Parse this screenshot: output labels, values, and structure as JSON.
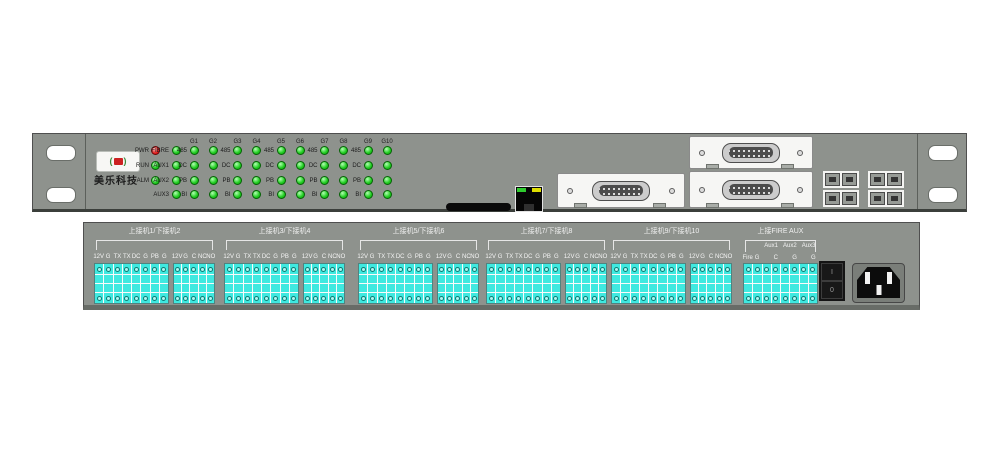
{
  "front_panel": {
    "brand_name": "美乐科技",
    "led_column_headers": [
      "G1",
      "G2",
      "G3",
      "G4",
      "G5",
      "G6",
      "G7",
      "G8",
      "G9",
      "G10"
    ],
    "led_rows": [
      {
        "status": "PWR",
        "status_color": "red",
        "aux": "FIBRE",
        "pair_label": "485"
      },
      {
        "status": "RUN",
        "status_color": "green",
        "aux": "AUX1",
        "pair_label": "DC"
      },
      {
        "status": "ALM",
        "status_color": "green",
        "aux": "AUX2",
        "pair_label": "PB"
      },
      {
        "status": "",
        "status_color": "",
        "aux": "AUX3",
        "pair_label": "BI"
      }
    ]
  },
  "rear_panel": {
    "channel_groups": [
      {
        "label": "上接机1/下接机2"
      },
      {
        "label": "上接机3/下接机4"
      },
      {
        "label": "上接机5/下接机6"
      },
      {
        "label": "上接机7/下接机8"
      },
      {
        "label": "上接机9/下接机10"
      }
    ],
    "main_block_terminals": [
      "12V",
      "G",
      "TX",
      "TX",
      "DC",
      "G",
      "PB",
      "G"
    ],
    "relay_block_terminals": [
      "12V",
      "G",
      "C",
      "NC",
      "NO"
    ],
    "aux_group": {
      "label": "上接FIRE AUX",
      "sub_labels": [
        "Aux1",
        "Aux2",
        "Aux3"
      ],
      "terminals": [
        "Fire",
        "G",
        "",
        "C",
        "",
        "G",
        "",
        "G"
      ]
    },
    "power_switch": {
      "on": "I",
      "off": "0"
    }
  },
  "colors": {
    "panel": "#8e928d",
    "led_green": "green",
    "led_red": "red",
    "terminal_cyan": "#3fe9e0"
  }
}
